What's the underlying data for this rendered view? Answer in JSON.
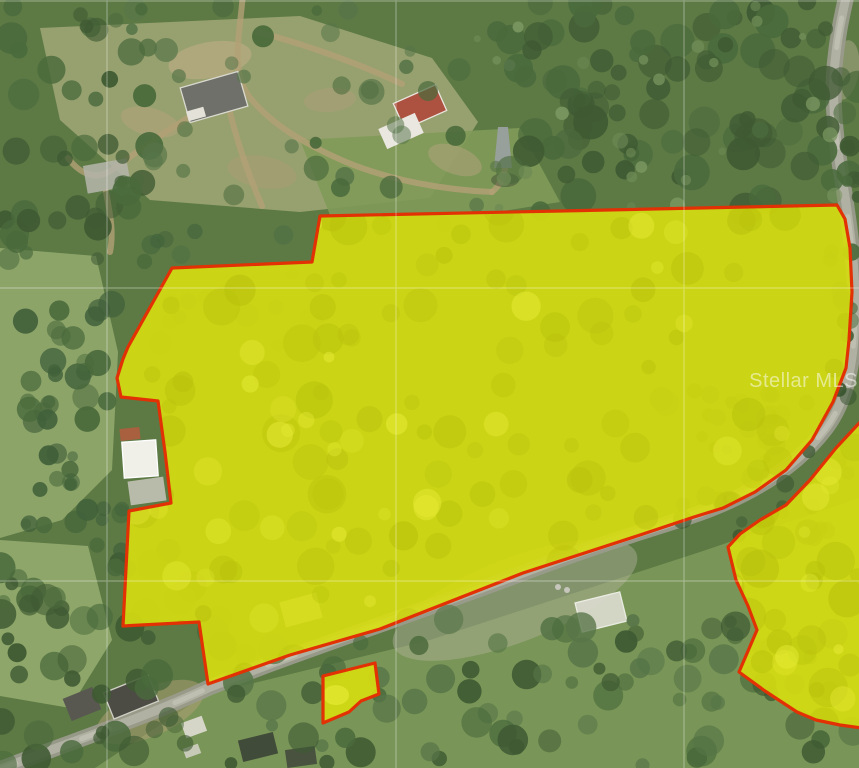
{
  "canvas": {
    "w": 859,
    "h": 768
  },
  "watermark": {
    "text": "Stellar MLS"
  },
  "palette": {
    "base": "#5d7a45",
    "forest_dark": "#3f5a33",
    "forest_mid": "#4a6a3c",
    "forest_light": "#577548",
    "parcel_fill": "#d7de10",
    "parcel_blotch_dark": "#b9c20c",
    "parcel_blotch_light": "#e7ec36",
    "parcel_stroke": "#e23104",
    "road": "#9b9b8d",
    "road_light": "#b5b5a8",
    "dirt": "#b3a076",
    "grid": "#ffffff"
  },
  "gridlines": {
    "vertical": [
      107,
      396,
      684
    ],
    "horizontal": [
      1,
      288,
      581
    ]
  },
  "parcels": {
    "main": {
      "points": [
        [
          320,
          216
        ],
        [
          560,
          211
        ],
        [
          837,
          205
        ],
        [
          845,
          219
        ],
        [
          850,
          248
        ],
        [
          852,
          292
        ],
        [
          849,
          340
        ],
        [
          846,
          368
        ],
        [
          833,
          402
        ],
        [
          812,
          440
        ],
        [
          786,
          470
        ],
        [
          755,
          492
        ],
        [
          723,
          508
        ],
        [
          694,
          517
        ],
        [
          640,
          535
        ],
        [
          523,
          573
        ],
        [
          380,
          629
        ],
        [
          290,
          655
        ],
        [
          208,
          684
        ],
        [
          199,
          622
        ],
        [
          123,
          626
        ],
        [
          129,
          511
        ],
        [
          171,
          503
        ],
        [
          165,
          452
        ],
        [
          158,
          401
        ],
        [
          121,
          397
        ],
        [
          117,
          378
        ],
        [
          123,
          359
        ],
        [
          128,
          347
        ],
        [
          172,
          268
        ],
        [
          312,
          262
        ]
      ],
      "blotch_box": {
        "x": 125,
        "y": 210,
        "w": 725,
        "h": 470,
        "dark_n": 130,
        "light_n": 45
      }
    },
    "small": {
      "points": [
        [
          323,
          676
        ],
        [
          375,
          663
        ],
        [
          379,
          694
        ],
        [
          361,
          701
        ],
        [
          349,
          712
        ],
        [
          323,
          723
        ]
      ],
      "light_spot": {
        "cx": 336,
        "cy": 695,
        "rx": 13,
        "ry": 10
      }
    },
    "right": {
      "points": [
        [
          862,
          420
        ],
        [
          836,
          448
        ],
        [
          810,
          480
        ],
        [
          786,
          505
        ],
        [
          760,
          520
        ],
        [
          740,
          534
        ],
        [
          728,
          547
        ],
        [
          736,
          580
        ],
        [
          748,
          606
        ],
        [
          757,
          630
        ],
        [
          739,
          672
        ],
        [
          765,
          691
        ],
        [
          797,
          712
        ],
        [
          816,
          720
        ],
        [
          840,
          725
        ],
        [
          862,
          728
        ]
      ],
      "blotch_box": {
        "x": 728,
        "y": 420,
        "w": 131,
        "h": 305,
        "dark_n": 30,
        "light_n": 10
      }
    }
  },
  "roads": {
    "main_road_path": "M -12 774 C 60 745 140 720 208 688 C 300 651 420 612 523 573 C 610 540 660 527 700 513 C 755 493 798 465 826 428 C 847 400 854 362 855 315 C 856 268 849 222 843 184 C 836 144 831 100 835 62 C 838 30 844 8 848 -12",
    "dirt_paths": [
      "M 243 -6 C 239 40 231 70 248 95 C 268 122 302 143 346 162 C 392 181 446 190 492 192",
      "M 240 88 C 204 106 158 136 112 170 C 96 181 80 174 68 158",
      "M 258 32 C 300 43 356 62 402 84",
      "M 492 192 C 501 185 505 174 506 162",
      "M 228 104 C 238 148 252 183 262 206",
      "M 106 192 C 110 214 114 232 110 252"
    ]
  },
  "fields": [
    {
      "pts": [
        [
          0,
          248
        ],
        [
          96,
          256
        ],
        [
          118,
          352
        ],
        [
          112,
          470
        ],
        [
          62,
          520
        ],
        [
          0,
          538
        ]
      ],
      "fill": "#8fa76c",
      "op": 0.95
    },
    {
      "pts": [
        [
          0,
          540
        ],
        [
          88,
          546
        ],
        [
          112,
          640
        ],
        [
          70,
          708
        ],
        [
          0,
          696
        ]
      ],
      "fill": "#93ab6d",
      "op": 0.9
    },
    {
      "pts": [
        [
          40,
          28
        ],
        [
          300,
          16
        ],
        [
          432,
          58
        ],
        [
          478,
          122
        ],
        [
          430,
          198
        ],
        [
          300,
          212
        ],
        [
          150,
          200
        ],
        [
          60,
          120
        ]
      ],
      "fill": "#9aa372",
      "op": 0.95
    },
    {
      "pts": [
        [
          300,
          140
        ],
        [
          520,
          128
        ],
        [
          560,
          202
        ],
        [
          478,
          215
        ],
        [
          330,
          215
        ]
      ],
      "fill": "#7f9a58",
      "op": 0.9
    },
    {
      "pts": [
        [
          205,
          695
        ],
        [
          430,
          640
        ],
        [
          700,
          552
        ],
        [
          859,
          498
        ],
        [
          859,
          768
        ],
        [
          95,
          768
        ]
      ],
      "fill": "#7e9a5a",
      "op": 0.85
    }
  ],
  "dirt_patches": [
    {
      "cx": 210,
      "cy": 60,
      "rx": 42,
      "ry": 18,
      "rot": -10,
      "fill": "#b9ab82",
      "op": 0.7
    },
    {
      "cx": 150,
      "cy": 122,
      "rx": 30,
      "ry": 14,
      "rot": 15,
      "fill": "#b3a47c",
      "op": 0.6
    },
    {
      "cx": 330,
      "cy": 100,
      "rx": 26,
      "ry": 12,
      "rot": -5,
      "fill": "#ad9f78",
      "op": 0.55
    },
    {
      "cx": 455,
      "cy": 160,
      "rx": 28,
      "ry": 14,
      "rot": 20,
      "fill": "#b0a37c",
      "op": 0.55
    },
    {
      "cx": 262,
      "cy": 172,
      "rx": 35,
      "ry": 16,
      "rot": 10,
      "fill": "#ab9d76",
      "op": 0.5
    },
    {
      "cx": 515,
      "cy": 600,
      "rx": 130,
      "ry": 42,
      "rot": -21,
      "fill": "#b2b29c",
      "op": 0.45
    },
    {
      "cx": 150,
      "cy": 712,
      "rx": 58,
      "ry": 24,
      "rot": -24,
      "fill": "#b3a076",
      "op": 0.5
    },
    {
      "cx": 845,
      "cy": 70,
      "rx": 14,
      "ry": 30,
      "rot": 8,
      "fill": "#b0a98c",
      "op": 0.5
    }
  ],
  "buildings": [
    {
      "name": "barn-dark-roof",
      "cx": 214,
      "cy": 97,
      "w": 60,
      "h": 36,
      "rot": -16,
      "fill": "#70706a",
      "op": 1,
      "stroke": "#d9d9cf"
    },
    {
      "name": "barn-annex",
      "cx": 196,
      "cy": 114,
      "w": 18,
      "h": 10,
      "rot": -16,
      "fill": "#e4e2d8",
      "op": 1
    },
    {
      "name": "ruin-structure",
      "cx": 107,
      "cy": 176,
      "w": 44,
      "h": 28,
      "rot": -10,
      "fill": "#b4b4a8",
      "op": 0.88
    },
    {
      "name": "red-roof-house",
      "cx": 420,
      "cy": 107,
      "w": 46,
      "h": 28,
      "rot": -24,
      "fill": "#ad5240",
      "op": 1,
      "stroke": "#e8e6de"
    },
    {
      "name": "white-roof-house",
      "cx": 401,
      "cy": 131,
      "w": 40,
      "h": 22,
      "rot": -24,
      "fill": "#e9e7df",
      "op": 1
    },
    {
      "name": "notch-house-roof",
      "cx": 130,
      "cy": 434,
      "w": 20,
      "h": 12,
      "rot": -6,
      "fill": "#a8603f",
      "op": 1
    },
    {
      "name": "notch-house",
      "cx": 140,
      "cy": 459,
      "w": 34,
      "h": 36,
      "rot": -4,
      "fill": "#f0efe8",
      "op": 1,
      "stroke": "#ffffff"
    },
    {
      "name": "notch-house-pad",
      "cx": 147,
      "cy": 491,
      "w": 36,
      "h": 24,
      "rot": -8,
      "fill": "#c2c2b4",
      "op": 0.9
    },
    {
      "name": "roadside-house-a",
      "cx": 131,
      "cy": 697,
      "w": 48,
      "h": 28,
      "rot": -22,
      "fill": "#4c4c44",
      "op": 1,
      "stroke": "#cfcfc5"
    },
    {
      "name": "roadside-house-b",
      "cx": 82,
      "cy": 704,
      "w": 32,
      "h": 24,
      "rot": -22,
      "fill": "#585850",
      "op": 1
    },
    {
      "name": "roadside-shed",
      "cx": 194,
      "cy": 727,
      "w": 22,
      "h": 16,
      "rot": -20,
      "fill": "#d6d6c8",
      "op": 1
    },
    {
      "name": "roadside-pad",
      "cx": 192,
      "cy": 751,
      "w": 16,
      "h": 10,
      "rot": -20,
      "fill": "#cfcfc2",
      "op": 0.9
    },
    {
      "name": "east-building",
      "cx": 601,
      "cy": 612,
      "w": 46,
      "h": 30,
      "rot": -14,
      "fill": "#dddcd2",
      "op": 0.9,
      "stroke": "#f6f6f0"
    },
    {
      "name": "bottom-building-a",
      "cx": 258,
      "cy": 747,
      "w": 36,
      "h": 22,
      "rot": -14,
      "fill": "#414b39",
      "op": 1
    },
    {
      "name": "bottom-building-b",
      "cx": 301,
      "cy": 757,
      "w": 30,
      "h": 18,
      "rot": -8,
      "fill": "#49523f",
      "op": 1
    },
    {
      "name": "shed-under-parcel",
      "cx": 301,
      "cy": 610,
      "w": 38,
      "h": 26,
      "rot": -15,
      "fill": "#c9c9ba",
      "op": 1
    }
  ],
  "tower": {
    "points": [
      [
        494,
        168
      ],
      [
        512,
        168
      ],
      [
        508,
        127
      ],
      [
        498,
        127
      ]
    ],
    "fill": "#9aa0a0",
    "shadow": {
      "cx": 505,
      "cy": 180,
      "rx": 14,
      "ry": 7,
      "fill": "#3a4433",
      "op": 0.45
    }
  },
  "cars": [
    {
      "cx": 558,
      "cy": 587,
      "r": 3
    },
    {
      "cx": 567,
      "cy": 590,
      "r": 3
    }
  ],
  "texture_regions": [
    {
      "x": 500,
      "y": 0,
      "w": 359,
      "h": 212,
      "n": 95,
      "rmin": 7,
      "rmax": 18,
      "colors": [
        "#3f5a33",
        "#4a6a3c"
      ],
      "seed": 1
    },
    {
      "x": 0,
      "y": 0,
      "w": 150,
      "h": 262,
      "n": 42,
      "rmin": 6,
      "rmax": 16,
      "colors": [
        "#3f5a33",
        "#4a6a3c"
      ],
      "seed": 2
    },
    {
      "x": 130,
      "y": 0,
      "w": 380,
      "h": 225,
      "n": 40,
      "rmin": 5,
      "rmax": 13,
      "colors": [
        "#4a6a3c",
        "#577548"
      ],
      "seed": 3
    },
    {
      "x": 25,
      "y": 295,
      "w": 100,
      "h": 145,
      "n": 26,
      "rmin": 6,
      "rmax": 14,
      "colors": [
        "#40603a",
        "#4a6a3c"
      ],
      "seed": 4
    },
    {
      "x": 25,
      "y": 430,
      "w": 75,
      "h": 110,
      "n": 14,
      "rmin": 5,
      "rmax": 12,
      "colors": [
        "#40603a",
        "#4a6a3c"
      ],
      "seed": 5
    },
    {
      "x": 0,
      "y": 550,
      "w": 215,
      "h": 218,
      "n": 46,
      "rmin": 6,
      "rmax": 16,
      "colors": [
        "#3f5a33",
        "#4a6a3c"
      ],
      "seed": 6
    },
    {
      "x": 200,
      "y": 618,
      "w": 659,
      "h": 150,
      "n": 85,
      "rmin": 6,
      "rmax": 16,
      "colors": [
        "#3f5a33",
        "#4a6a3c",
        "#577548"
      ],
      "seed": 7
    },
    {
      "x": 660,
      "y": 385,
      "w": 199,
      "h": 175,
      "n": 44,
      "rmin": 5,
      "rmax": 13,
      "colors": [
        "#36512e",
        "#3f5a33"
      ],
      "seed": 8
    },
    {
      "x": 828,
      "y": 175,
      "w": 31,
      "h": 170,
      "n": 14,
      "rmin": 5,
      "rmax": 10,
      "colors": [
        "#3f5a33",
        "#4a6a3c"
      ],
      "seed": 9
    },
    {
      "x": 470,
      "y": 0,
      "w": 389,
      "h": 210,
      "n": 26,
      "rmin": 3,
      "rmax": 8,
      "colors": [
        "#6d8a55",
        "#7a9660"
      ],
      "seed": 10
    },
    {
      "x": 150,
      "y": 230,
      "w": 180,
      "h": 120,
      "n": 22,
      "rmin": 5,
      "rmax": 12,
      "colors": [
        "#44643c",
        "#507044"
      ],
      "seed": 11
    },
    {
      "x": 95,
      "y": 505,
      "w": 40,
      "h": 70,
      "n": 8,
      "rmin": 5,
      "rmax": 11,
      "colors": [
        "#40603a",
        "#4a6a3c"
      ],
      "seed": 12
    }
  ]
}
